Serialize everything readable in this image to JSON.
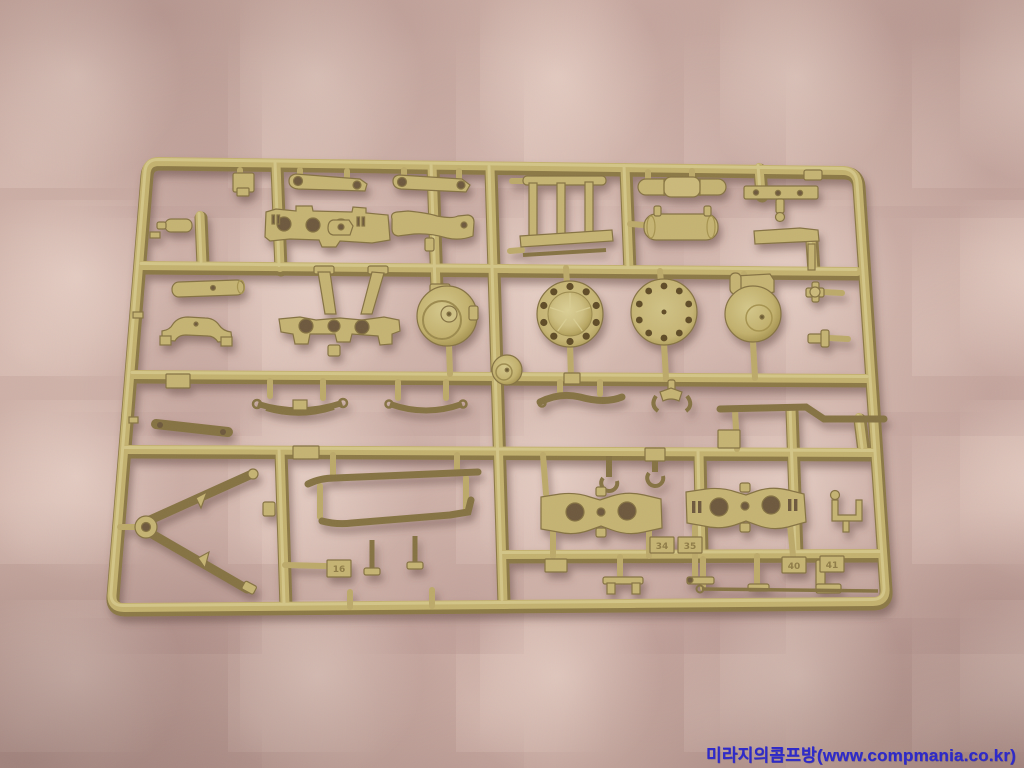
{
  "scene": {
    "type": "photograph",
    "description": "A tan (dark-yellow) injection-molded plastic model kit sprue / parts tree lying on a pink quilted blanket, photographed from above",
    "background": {
      "name": "pink-quilted-blanket",
      "base_color": "#c9aaa1",
      "highlight_color": "#f4dfd5",
      "shadow_color": "#9c7d78"
    },
    "sprue": {
      "name": "tan-model-kit-sprue",
      "plastic_color": "#c5b372",
      "plastic_highlight": "#d9cc90",
      "plastic_shadow": "#8b7844",
      "hole_color": "#5f4c2a",
      "part_number_tags": [
        {
          "label": "16"
        },
        {
          "label": "34"
        },
        {
          "label": "35"
        },
        {
          "label": "40"
        },
        {
          "label": "41"
        }
      ],
      "parts_visible": [
        "link bars with end holes",
        "drilled mounting plate",
        "curved bracket",
        "ladder frame part",
        "segmented cylinder",
        "fuel-tank style cylinder",
        "bolt strip",
        "axle plate with A-frame legs",
        "spiral final-drive housing",
        "domed hub disc with bolt holes",
        "flat drilled disc",
        "hinged drum cover",
        "small hub disc",
        "leaf springs",
        "tow link bar",
        "V-shaped trail legs",
        "long bent rods",
        "bogie side plates with holes",
        "hooks and small brackets"
      ]
    },
    "watermark": {
      "text": "미라지의콤프방(www.compmania.co.kr)",
      "color": "#2a26cb"
    }
  }
}
